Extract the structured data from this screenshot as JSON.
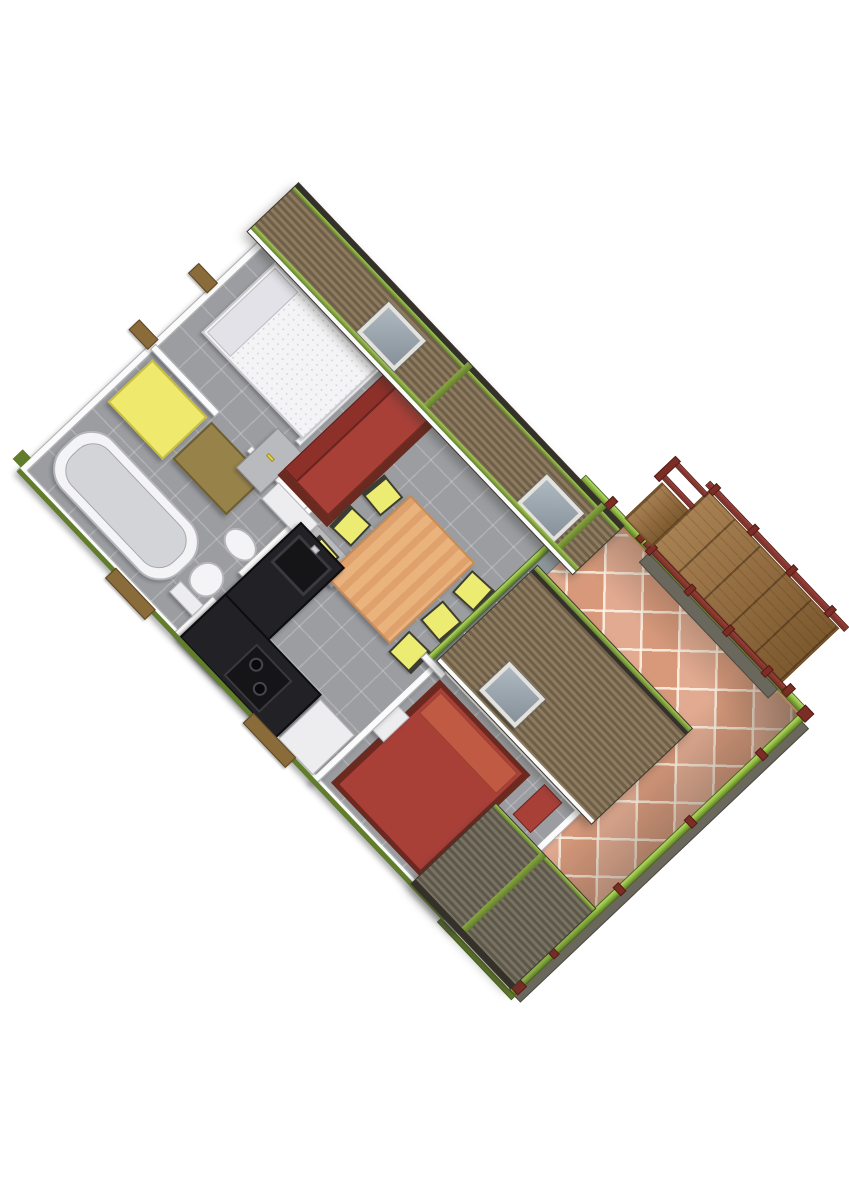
{
  "scene": {
    "title": "3D cutaway floor plan rendering — mobile home with furnished interior, tiled terrace and wooden access ramp",
    "view": "axonometric top-down view rotated about 46 degrees on a white background",
    "rotation_deg": 46.5
  },
  "palette": {
    "bg": "#ffffff",
    "floor": "#9b9da1",
    "wall": "#fbfbfb",
    "wall-edge": "#b2b2b6",
    "roof-a": "#8c7b5e",
    "roof-b": "#6f5f49",
    "roof2-a": "#787260",
    "roof2-b": "#5c564b",
    "fascia": "#34302a",
    "green": "#8fbc3f",
    "green-dark": "#617d2b",
    "tile": "#dfa184",
    "tile-edge": "#bb8159",
    "maroon": "#7c2d26",
    "red": "#a84038",
    "red-dark": "#8c3029",
    "red-base": "#6b2a20",
    "pillow-red": "#c05a42",
    "white-soft": "#f4f4f6",
    "pillow-gray": "#e2e2e8",
    "yellow": "#efe96e",
    "brown": "#97824a",
    "wood-table": "#eab37e",
    "wood-edge": "#c98b54",
    "chair": "#ecec72",
    "chair-frame": "#3c3c32",
    "k-black": "#222226",
    "k-dark": "#151518",
    "k-rim": "#3a3a3e",
    "white-box": "#ededef",
    "glass": "#8d979c",
    "ramp-wood": "#9c6f3a",
    "ramp-dark": "#6b4a26",
    "step": "#8a6b3a",
    "sideface": "#6a675c"
  },
  "building": {
    "rooms": [
      {
        "name": "bedroom-1",
        "furniture": [
          "white-double-bed",
          "pillow",
          "brown-wardrobe",
          "yellow-shower-cabin"
        ]
      },
      {
        "name": "bathroom-wc",
        "furniture": [
          "bathtub",
          "toilet",
          "washbasin",
          "doors-with-yellow-handles"
        ]
      },
      {
        "name": "living-dining",
        "furniture": [
          "red-sofa-bench",
          "wood-dining-table",
          "six-yellow-chairs"
        ]
      },
      {
        "name": "kitchen",
        "furniture": [
          "black-l-counter",
          "sink",
          "stove",
          "white-fridge-cabinet"
        ]
      },
      {
        "name": "bedroom-2",
        "furniture": [
          "red-double-bed",
          "red-pillow",
          "nightstand",
          "red-wardrobe"
        ]
      },
      {
        "name": "terrace",
        "features": [
          "diagonal-terracotta-tiles",
          "lime-green-railings",
          "maroon-posts"
        ]
      },
      {
        "name": "access-ramp",
        "features": [
          "wood-plank-deck",
          "maroon-handrails",
          "gray-substructure"
        ]
      }
    ],
    "roofs": [
      {
        "name": "main-roof",
        "material": "brown-slats",
        "skylights": 2,
        "trim": "green-battens"
      },
      {
        "name": "entry-roof",
        "material": "brown-slats",
        "skylights": 1,
        "trim": "green-eave"
      },
      {
        "name": "walkway-roof",
        "material": "gray-slats",
        "skylights": 0,
        "trim": "green-eave"
      }
    ],
    "exterior": [
      "white-cut-wall-tops",
      "green-chassis-trim",
      "brown-door-steps",
      "glass-sliding-walls"
    ]
  }
}
